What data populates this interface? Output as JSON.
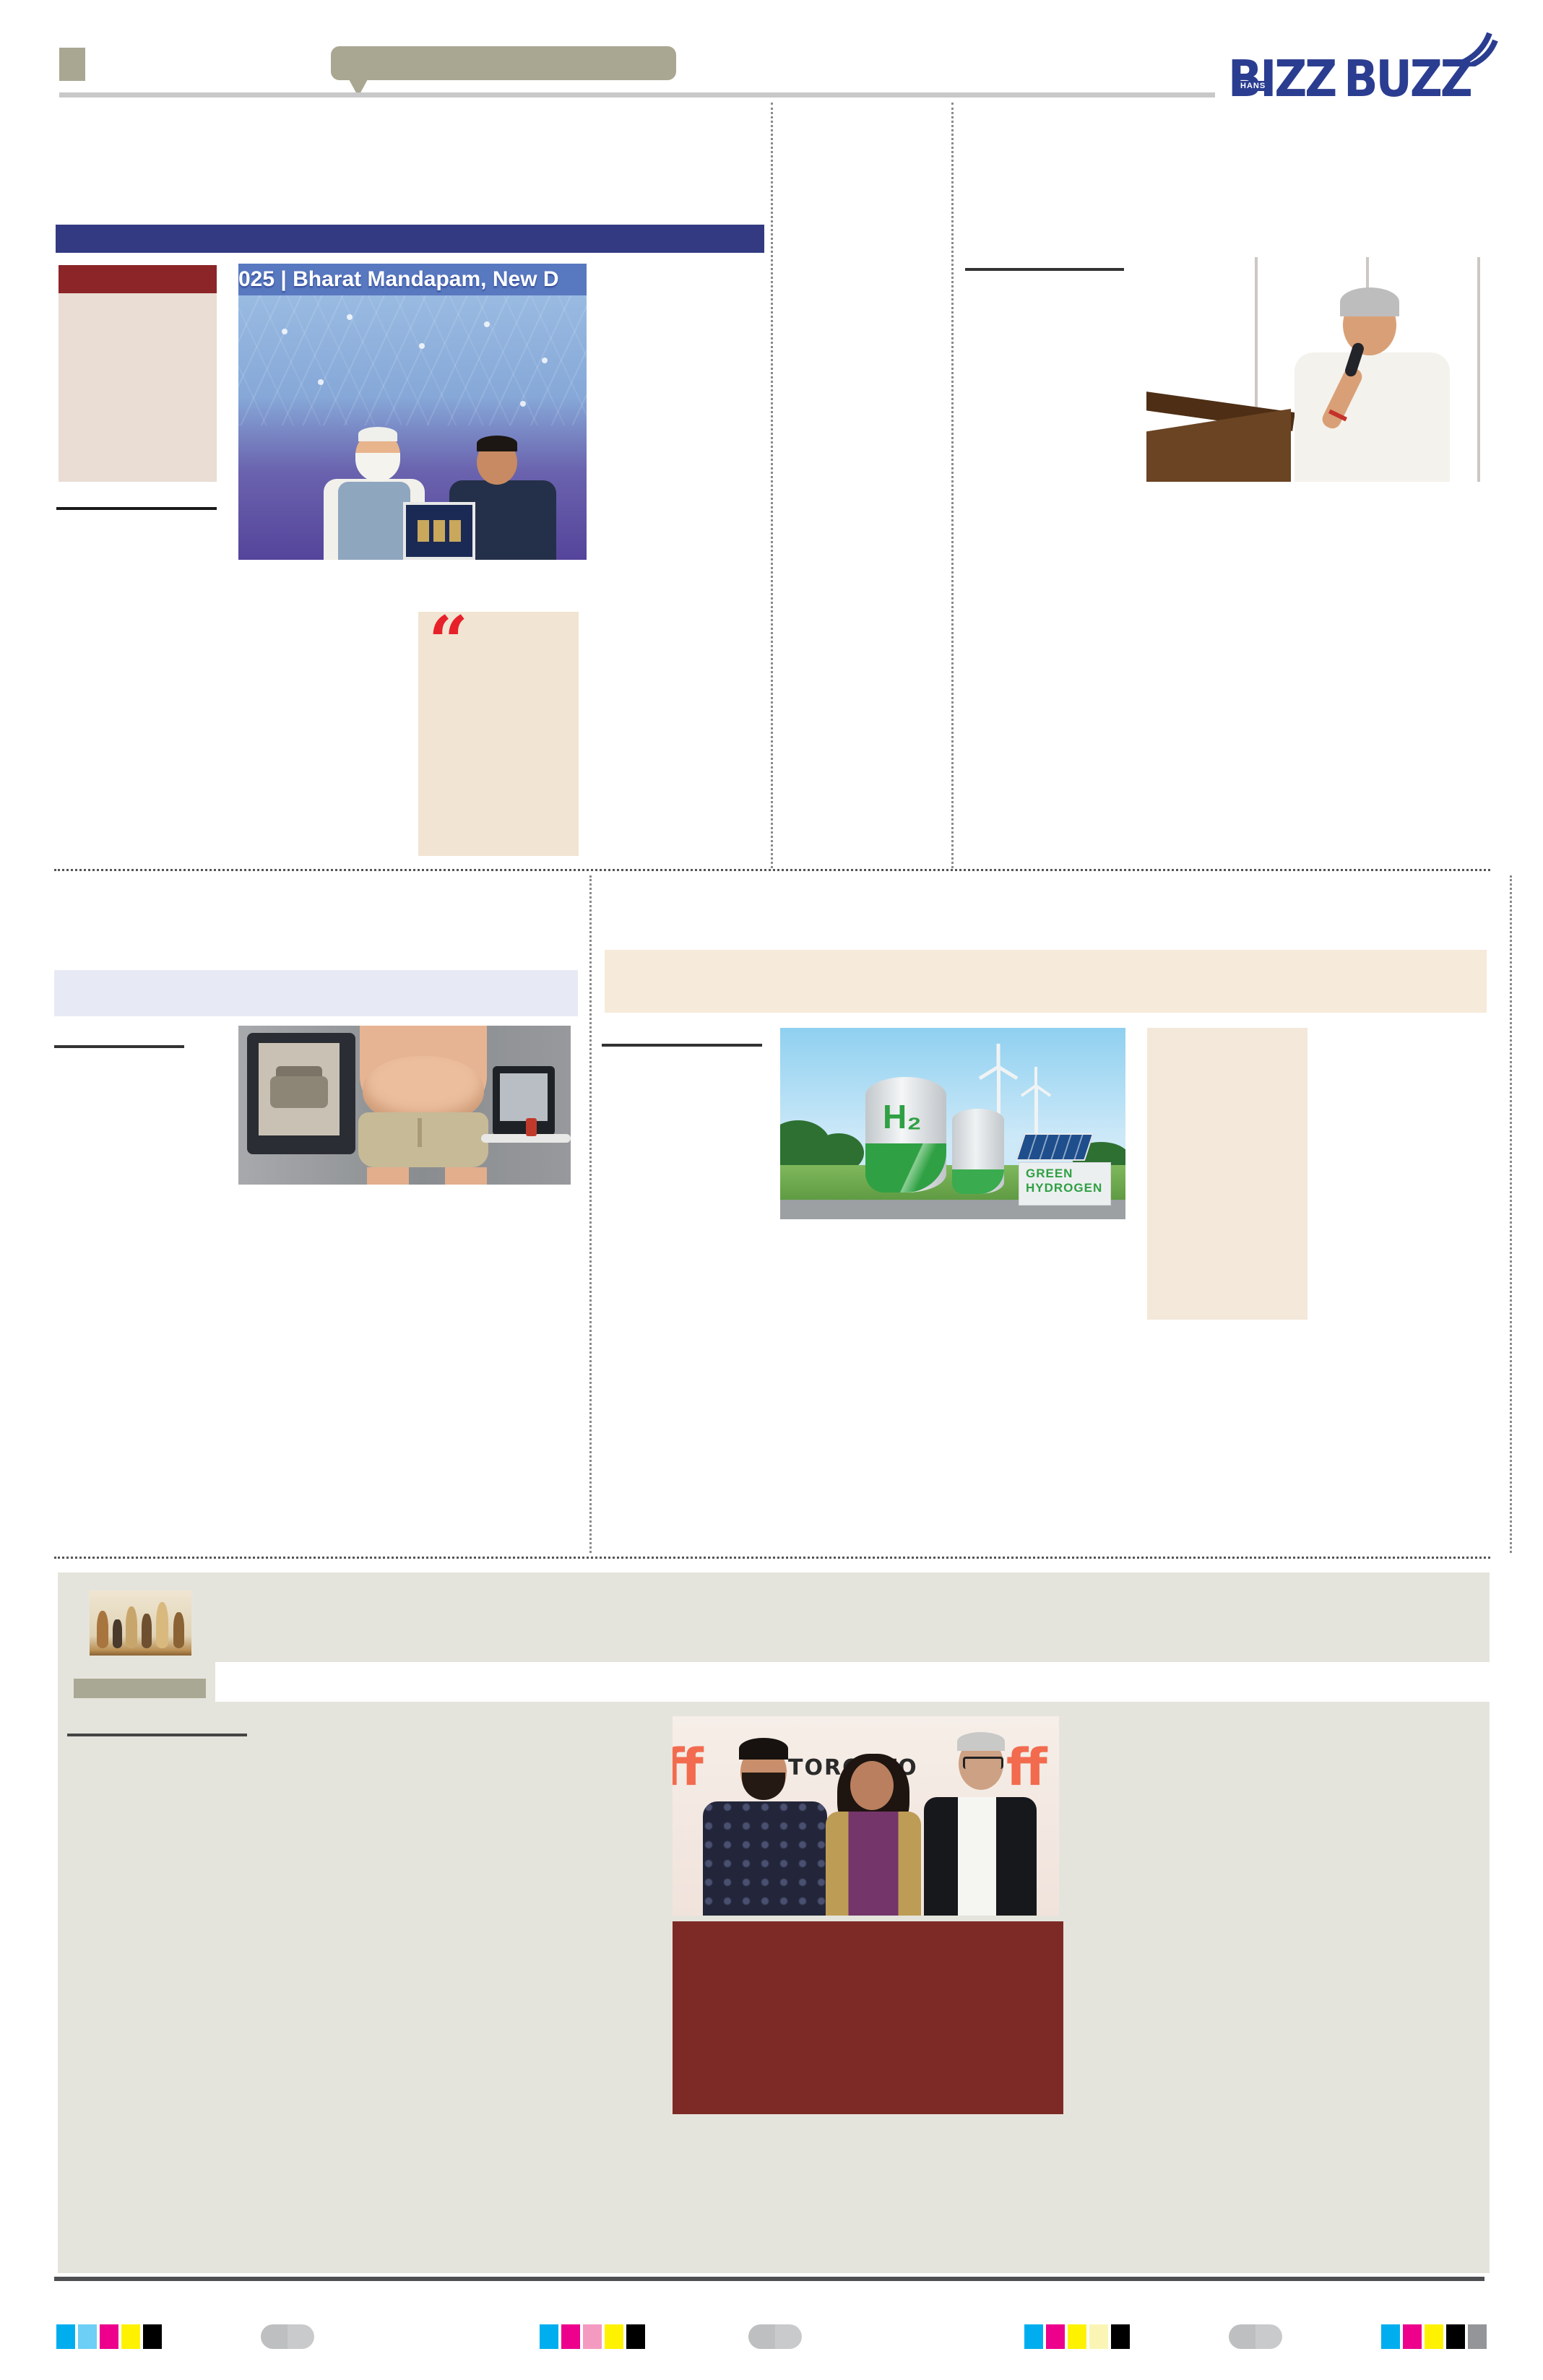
{
  "page": {
    "title": "BIZZ BUZZ newspaper page"
  },
  "header": {
    "logo": {
      "word1": "BIZZ",
      "word2": "BUZZ",
      "badge": "HANS"
    },
    "colors": {
      "logo_blue": "#2B3D90",
      "decor_olive": "#A9A692",
      "rule_gray": "#C8C8C8"
    }
  },
  "lead_story": {
    "photo_banner_text": "025 | Bharat Mandapam, New D",
    "quote_glyph": "“",
    "colors": {
      "headline_bar": "#333A82",
      "kicker": "#8C2528",
      "infobox": "#EADDD4",
      "quote_box": "#F1E4D2",
      "quote_red": "#E62129"
    }
  },
  "hydrogen_story": {
    "tank_label": "H₂",
    "caption_line1": "GREEN",
    "caption_line2": "HYDROGEN",
    "colors": {
      "banner": "#F6EADA",
      "sidebar": "#F3E8D9",
      "label_green": "#2FA043"
    }
  },
  "health_story": {
    "colors": {
      "highlight": "#E7EAF4"
    }
  },
  "entertainment": {
    "photo": {
      "logo_left": "ff",
      "backdrop_text": "TORONTO",
      "logo_right": "ff"
    },
    "colors": {
      "section_bg": "#E5E4DC",
      "kicker": "#A9A894",
      "panel": "#7D2A26",
      "tiff_orange": "#F26B4E"
    }
  },
  "print_marks": {
    "groups": [
      {
        "colors": [
          "#00AEEF",
          "#6DCFF6",
          "#EC008C",
          "#FFF200",
          "#000000"
        ]
      },
      {
        "colors": [
          "#00AEEF",
          "#EC008C",
          "#F49AC1",
          "#FFF200",
          "#000000"
        ]
      },
      {
        "colors": [
          "#00AEEF",
          "#EC008C",
          "#FFF200",
          "#FBF5B5",
          "#000000"
        ]
      },
      {
        "colors": [
          "#00AEEF",
          "#EC008C",
          "#FFF200",
          "#000000",
          "#939598"
        ]
      }
    ],
    "oval_color": "#C5C7C9"
  }
}
